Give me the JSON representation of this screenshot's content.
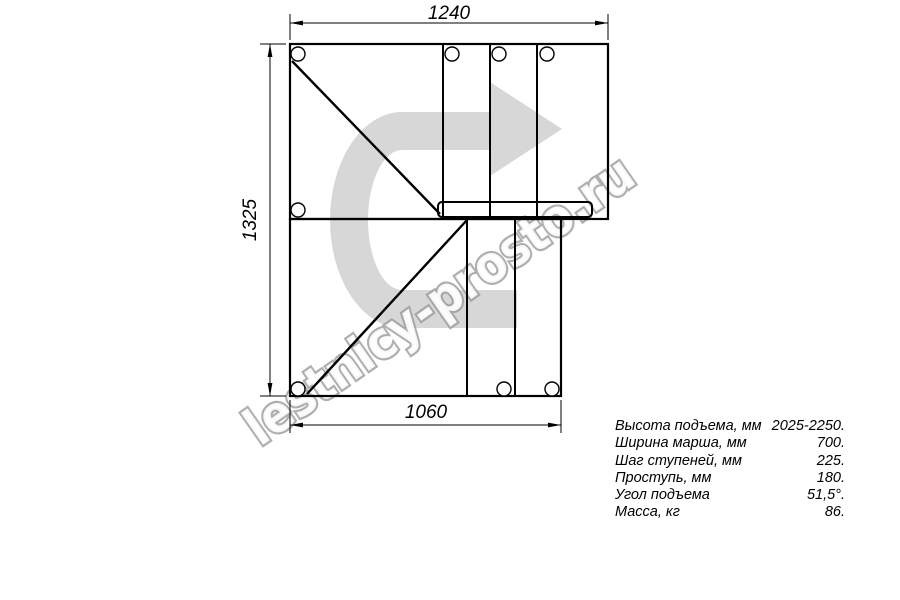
{
  "colors": {
    "line": "#000000",
    "arrow_fill": "#d7d7d7",
    "watermark_outline": "#9c9c9c",
    "background": "#ffffff"
  },
  "dimensions": {
    "top_width_mm": "1240",
    "left_height_mm": "1325",
    "bottom_width_mm": "1060"
  },
  "watermark": {
    "text": "lestnicy-prosto.ru"
  },
  "specs": {
    "rows": [
      {
        "label": "Высота подъема, мм",
        "value": "2025-2250."
      },
      {
        "label": "Ширина марша, мм",
        "value": "700."
      },
      {
        "label": "Шаг ступеней, мм",
        "value": "225."
      },
      {
        "label": "Проступь, мм",
        "value": "180."
      },
      {
        "label": "Угол подъема",
        "value": "51,5°."
      },
      {
        "label": "Масса, кг",
        "value": "86."
      }
    ]
  }
}
